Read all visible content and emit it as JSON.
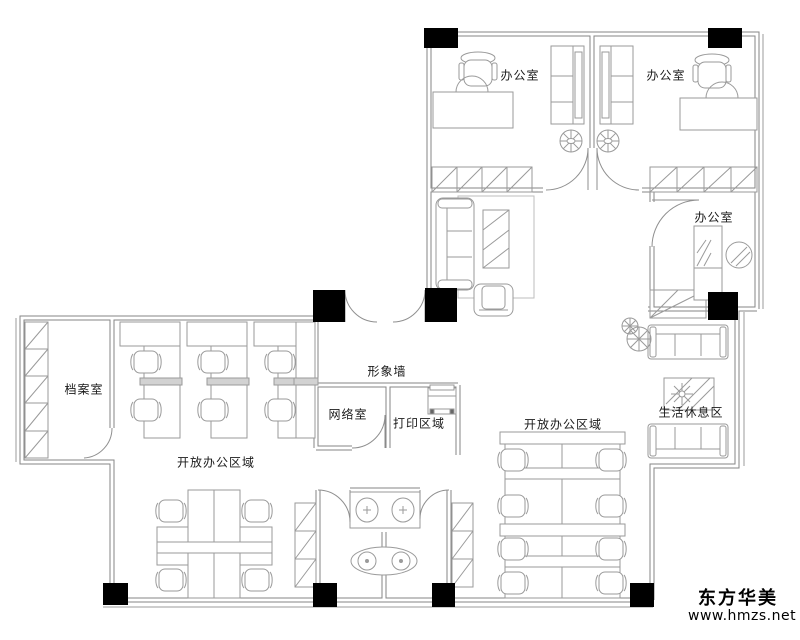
{
  "plan": {
    "labels": {
      "office1": "办公室",
      "office2": "办公室",
      "office3": "办公室",
      "archive": "档案室",
      "image_wall": "形象墙",
      "network": "网络室",
      "print": "打印区域",
      "open_office_left": "开放办公区域",
      "open_office_right": "开放办公区域",
      "rest": "生活休息区"
    }
  },
  "branding": {
    "company": "东方华美",
    "website": "www.hmzs.net"
  },
  "colors": {
    "background": "#ffffff",
    "wall": "#848484",
    "furniture": "#9a9a9a",
    "column": "#000000",
    "label_text": "#1a1a1a",
    "brand_text": "#000000"
  }
}
